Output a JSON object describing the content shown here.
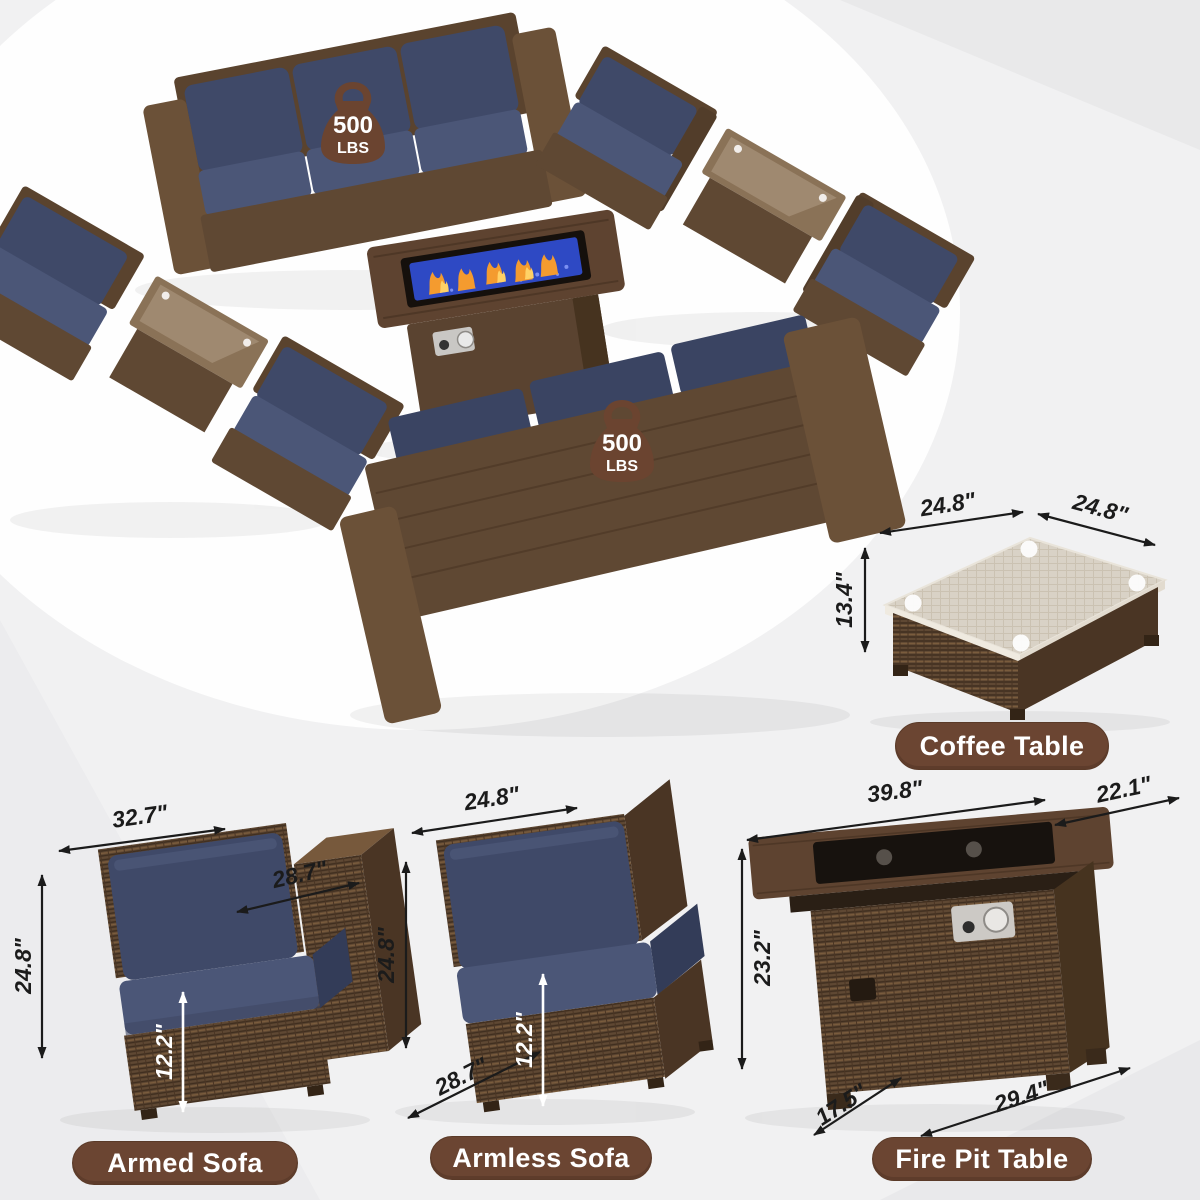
{
  "badge": {
    "value": "500",
    "unit": "LBS"
  },
  "diagrams": {
    "coffee_table": {
      "label": "Coffee Table",
      "dim_top_left": "24.8\"",
      "dim_top_right": "24.8\"",
      "dim_height": "13.4\""
    },
    "armed_sofa": {
      "label": "Armed Sofa",
      "dim_width": "32.7\"",
      "dim_depth": "28.7\"",
      "dim_height": "24.8\"",
      "dim_seat_height": "12.2\""
    },
    "armless_sofa": {
      "label": "Armless Sofa",
      "dim_width": "24.8\"",
      "dim_height": "24.8\"",
      "dim_seat_height": "12.2\"",
      "dim_depth": "28.7\""
    },
    "fire_pit_table": {
      "label": "Fire Pit Table",
      "dim_top_width": "39.8\"",
      "dim_top_depth": "22.1\"",
      "dim_height": "23.2\"",
      "dim_base_depth": "17.5\"",
      "dim_base_width": "29.4\""
    }
  },
  "colors": {
    "wicker_brown": "#5f4833",
    "cushion_navy": "#3f4968",
    "label_pill_brown": "#6b4532",
    "fire_glass_blue": "#2e49c4",
    "flame_orange": "#f49b2f"
  }
}
